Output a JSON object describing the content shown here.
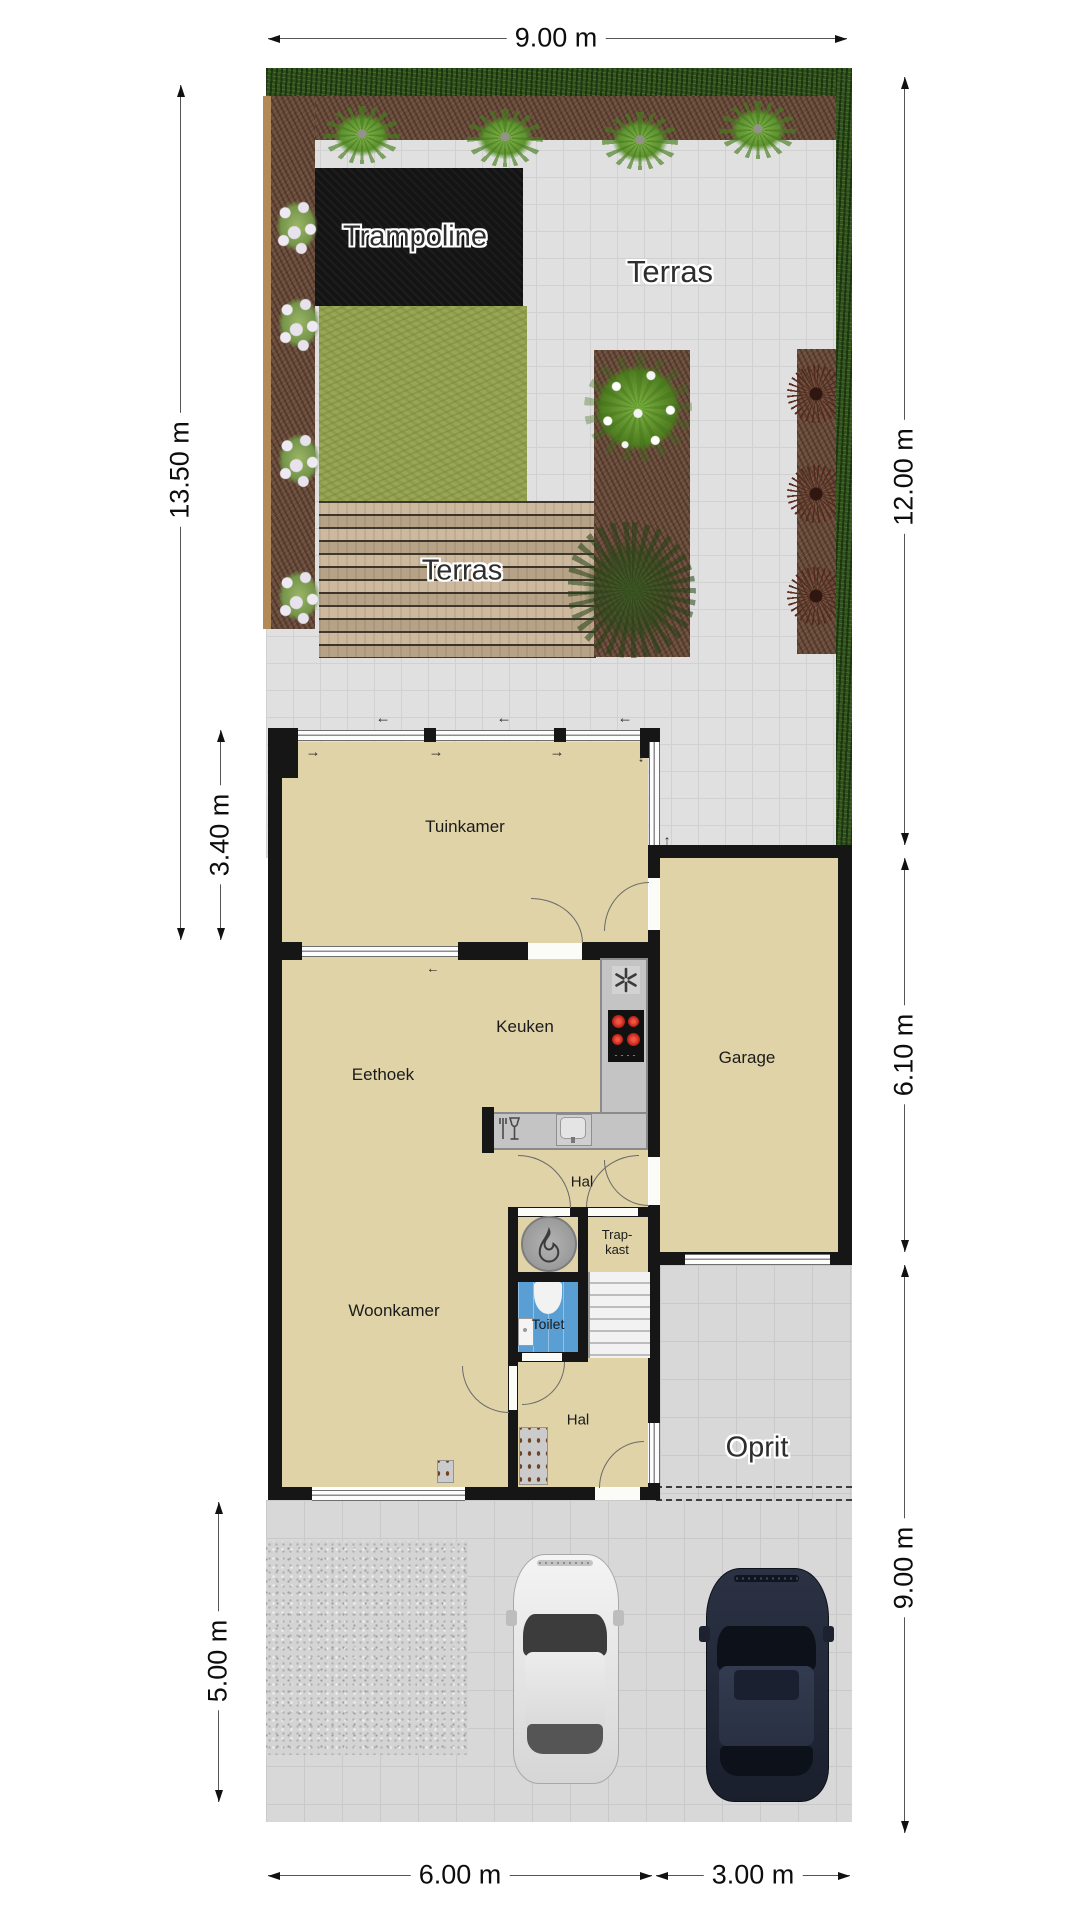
{
  "labels": {
    "trampoline": "Trampoline",
    "terras_top": "Terras",
    "terras_deck": "Terras",
    "tuinkamer": "Tuinkamer",
    "keuken": "Keuken",
    "eethoek": "Eethoek",
    "garage": "Garage",
    "hal_upper": "Hal",
    "trapkast": "Trap-\nkast",
    "toilet": "Toilet",
    "woonkamer": "Woonkamer",
    "hal_lower": "Hal",
    "oprit": "Oprit"
  },
  "dimensions": {
    "top_width": "9.00 m",
    "left_garden_depth": "13.50 m",
    "left_tuinkamer_depth": "3.40 m",
    "left_parking_depth": "5.00 m",
    "right_garden_depth": "12.00 m",
    "right_garage_depth": "6.10 m",
    "right_driveway_depth": "9.00 m",
    "bottom_left_width": "6.00 m",
    "bottom_right_width": "3.00 m"
  },
  "arrows": {
    "left": "←",
    "right": "→",
    "up": "↑",
    "down": "↓"
  },
  "icons": {
    "extractor_fan": "six-blade-fan",
    "stove": "four-burner-hob",
    "kitchen_sink": "basin-with-tap",
    "dishwasher": "glass-and-fork-symbol",
    "fireplace": "flame-in-circle",
    "toilet_bowl": "toilet-top-view",
    "hand_basin": "small-basin",
    "radiator": "panel-with-dots",
    "thermostat": "small-panel-with-dots"
  },
  "colors": {
    "floor": "#dfd3a7",
    "wall": "#161616",
    "toilet_floor": "#5a9fd4",
    "grass": "#9aa657",
    "hedge": "#30501e",
    "soil": "#6b4b39",
    "deck": "#c6b091",
    "tiles": "#e0e0e0",
    "burner_red": "#cf2b20",
    "car_white": "#e9e9e9",
    "car_dark": "#262d3e"
  }
}
